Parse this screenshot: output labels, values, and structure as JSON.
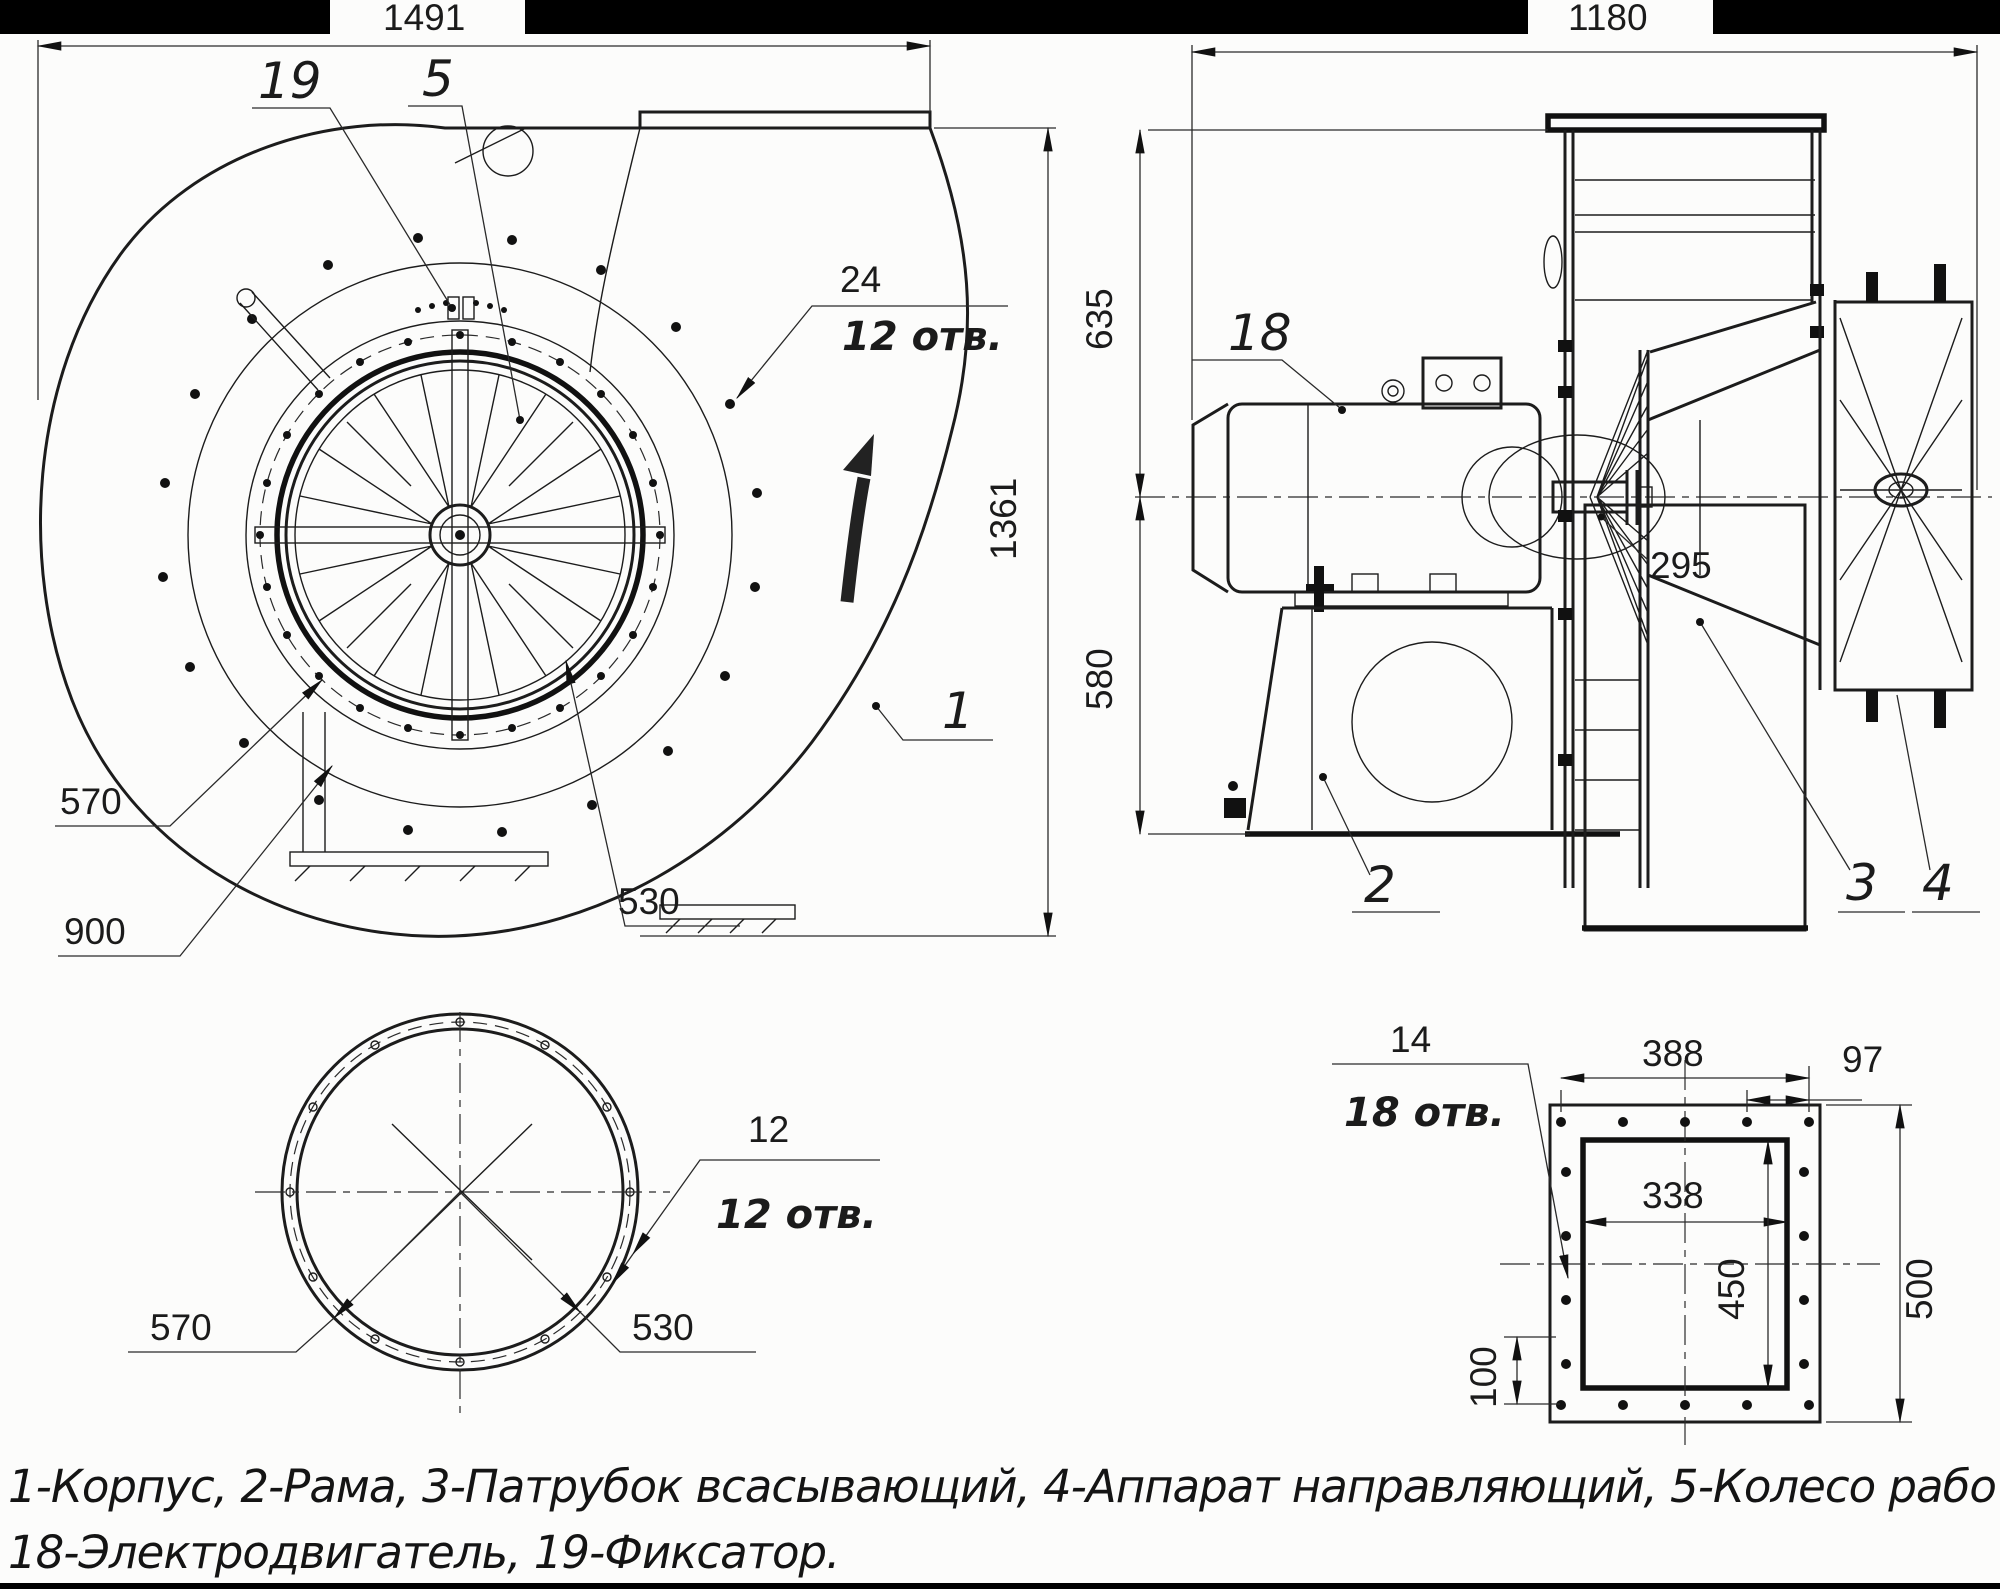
{
  "front_view": {
    "dim_width": "1491",
    "dim_height": "1361",
    "dim_inlet_outer": "570",
    "dim_casing": "900",
    "dim_bolt_circle": "530",
    "callout_fixator": "19",
    "callout_wheel": "5",
    "callout_hole_dia": "24",
    "callout_hole_count": "12 отв.",
    "callout_korpus": "1"
  },
  "side_view": {
    "dim_width": "1180",
    "dim_top": "635",
    "dim_bottom": "580",
    "dim_shaft": "295",
    "callout_motor": "18",
    "callout_frame": "2",
    "callout_branch": "3",
    "callout_apparatus": "4"
  },
  "inlet_flange_view": {
    "dim_outer": "570",
    "dim_bolt_circle": "530",
    "hole_dia": "12",
    "hole_count": "12 отв."
  },
  "outlet_flange_view": {
    "dim_span": "388",
    "dim_pitch": "97",
    "dim_inner_w": "338",
    "dim_inner_h": "450",
    "dim_outer_h": "500",
    "dim_offset": "100",
    "hole_dia": "14",
    "hole_count": "18 отв."
  },
  "legend": {
    "line1": "1-Корпус, 2-Рама, 3-Патрубок всасывающий, 4-Аппарат направляющий, 5-Колесо рабочее,",
    "line2": "18-Электродвигатель, 19-Фиксатор."
  }
}
